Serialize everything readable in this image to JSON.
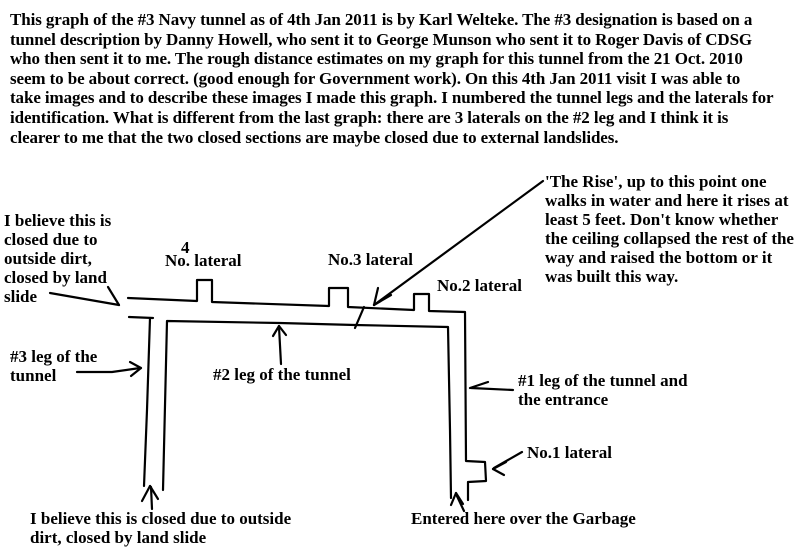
{
  "intro": {
    "lines": [
      "This graph of the #3 Navy tunnel as of 4th Jan 2011 is by Karl Welteke. The #3 designation is based on a",
      "tunnel description by Danny Howell, who sent it to George Munson who sent it to Roger Davis of CDSG",
      "who then sent it to me. The rough distance estimates on my graph for this tunnel from the 21 Oct. 2010",
      "seem to be about correct. (good enough for Government work).  On this 4th Jan 2011 visit I was able to",
      "take images and to describe these images I made this graph. I numbered the tunnel legs and the laterals for",
      "identification. What is different from the last graph: there are 3 laterals on the #2 leg and I think it is",
      "clearer to me that the two closed sections are maybe closed due to external landslides."
    ]
  },
  "diagram": {
    "colors": {
      "ink": "#000000",
      "paper": "#ffffff"
    },
    "labels": {
      "closed_top": {
        "lines": [
          "I believe this is",
          "closed due to",
          "outside dirt,",
          "closed by land",
          "slide"
        ]
      },
      "lateral4_num": "4",
      "lateral4": "No. lateral",
      "lateral3": "No.3 lateral",
      "lateral2": "No.2 lateral",
      "rise": {
        "lines": [
          "'The Rise', up to this point one",
          "walks in water and here it rises at",
          "least 5 feet. Don't know whether",
          "the ceiling collapsed the rest of the",
          "way and raised the bottom or it",
          "was built this way."
        ]
      },
      "leg3": {
        "lines": [
          "#3 leg of the",
          "tunnel"
        ]
      },
      "leg2": "#2 leg of the tunnel",
      "leg1": {
        "lines": [
          "#1 leg of the tunnel and",
          "the entrance"
        ]
      },
      "lateral1": "No.1 lateral",
      "closed_bottom": {
        "lines": [
          "I believe this is closed due to outside",
          "dirt, closed by land slide"
        ]
      },
      "entered": "Entered here over the Garbage"
    }
  }
}
